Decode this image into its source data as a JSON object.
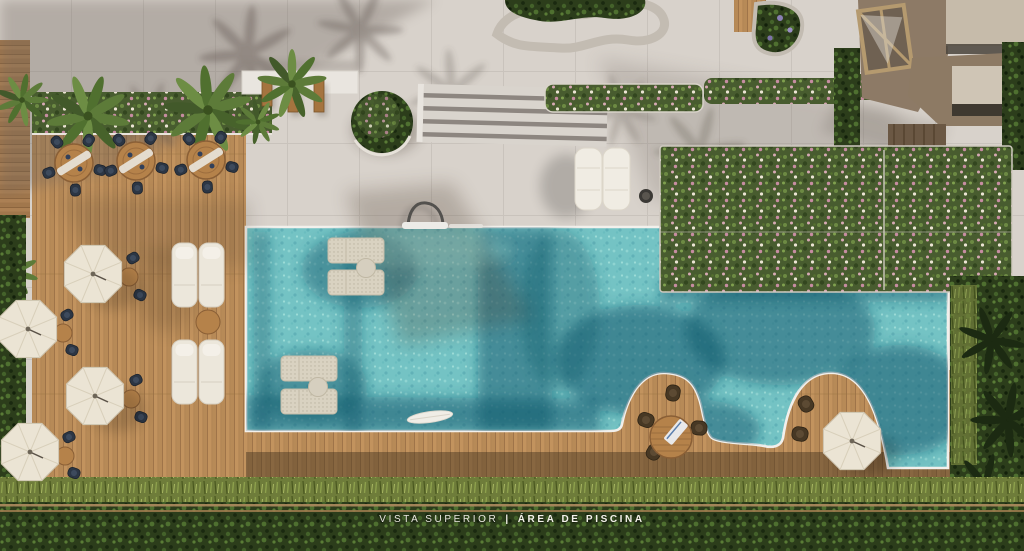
{
  "caption": {
    "view_label": "VISTA SUPERIOR",
    "separator": "|",
    "area_label": "ÁREA DE PISCINA"
  },
  "scene": {
    "description": "Aerial top-down architectural rendering of a residential pool area",
    "elements": [
      "swimming-pool",
      "wood-deck",
      "dining-sets",
      "parasols",
      "sun-loungers",
      "in-pool-loungers",
      "flowering-hedge-wall",
      "wide-stairs",
      "pergola-benches",
      "building-roof-skylight",
      "curved-planters",
      "palm-trees",
      "perimeter-hedge",
      "fence-rails"
    ],
    "counts": {
      "parasols": 5,
      "dining-sets": 3,
      "deck-lounger-pairs": 2,
      "paving-loungers": 2,
      "in-pool-lounger-sets": 2,
      "deck-peninsulas": 2
    }
  },
  "palette": {
    "paving": "#d8d2cb",
    "paving-shadow": "#b4aca8",
    "deck": "#c2935e",
    "deck-dark": "#7c5b3c",
    "pool": "#74c3c4",
    "pool-deep": "#14586b",
    "coping": "#f2f0ec",
    "hedge": "#485c2f",
    "hedge-dark": "#2c3d1b",
    "grass": "#6e7c3a",
    "umbrella": "#ebe4d4",
    "wood": "#b5824a",
    "chair": "#2c3644",
    "building-wall": "#8d7a66",
    "building-roof": "#c6bbaa",
    "caption": "#f4f1ea"
  }
}
